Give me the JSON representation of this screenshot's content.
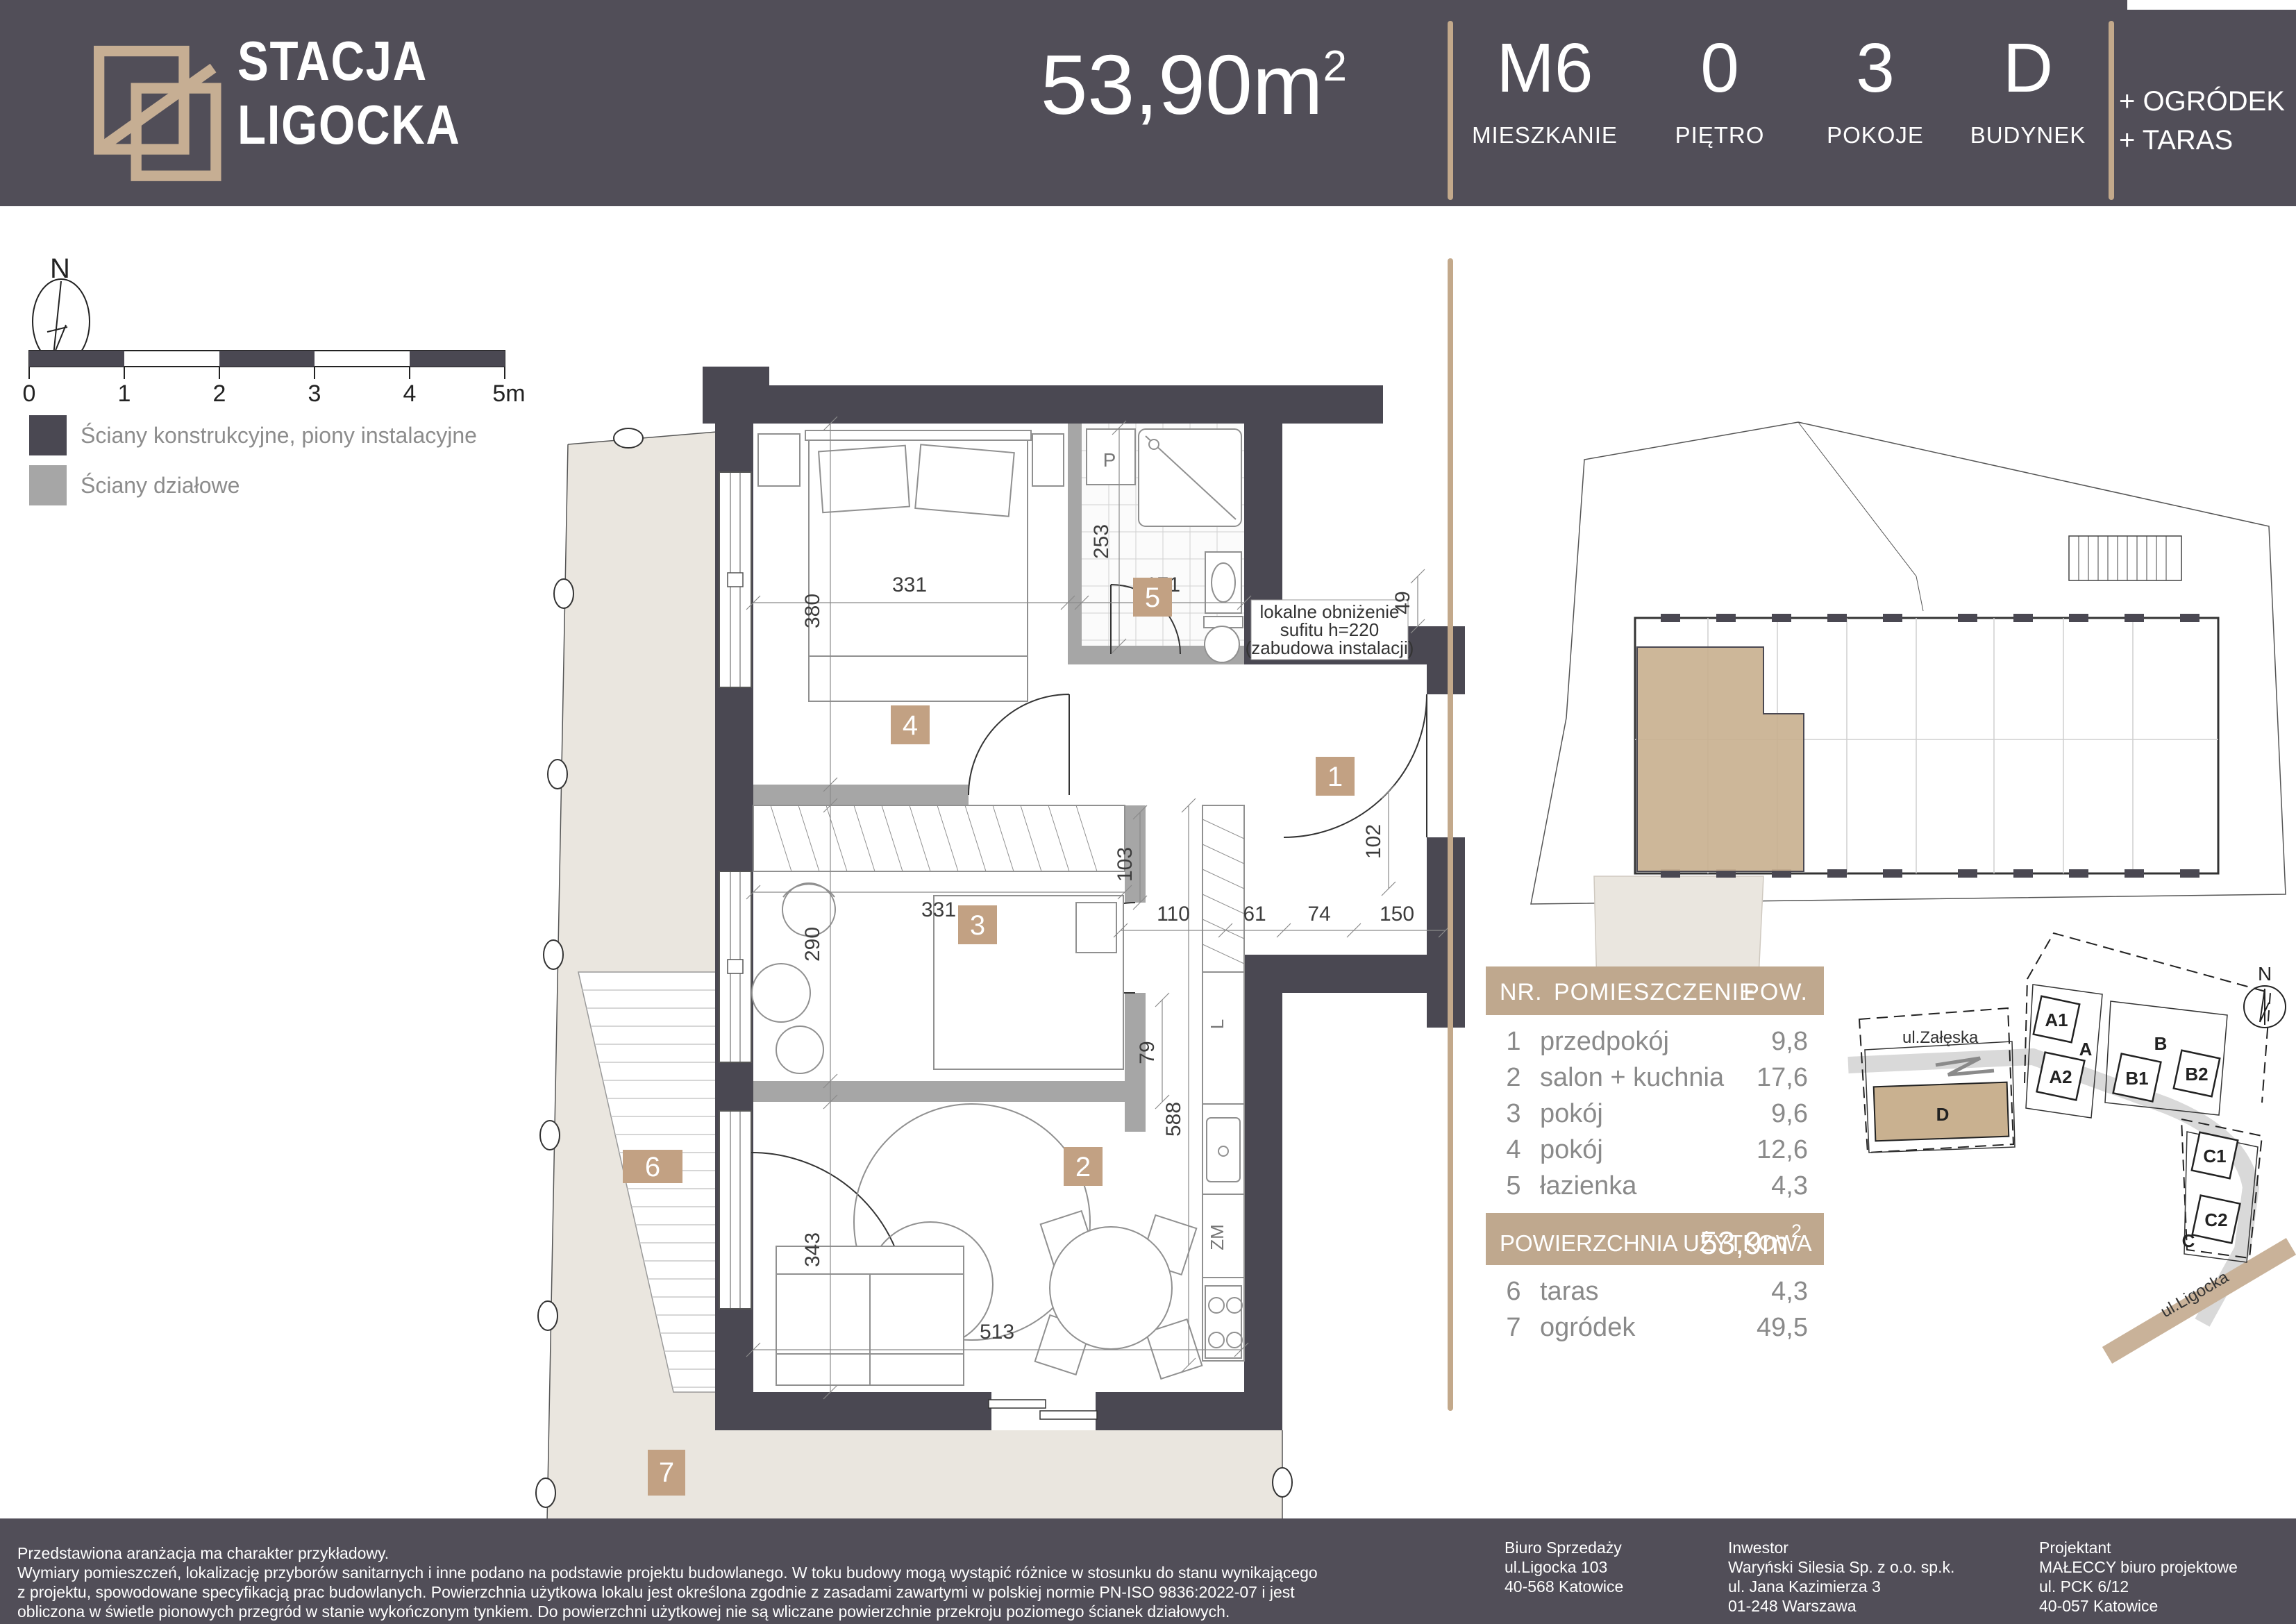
{
  "header": {
    "brand_line1": "STACJA",
    "brand_line2": "LIGOCKA",
    "area_value": "53,90m",
    "area_sup": "2",
    "units": [
      {
        "value": "M6",
        "label": "MIESZKANIE"
      },
      {
        "value": "0",
        "label": "PIĘTRO"
      },
      {
        "value": "3",
        "label": "POKOJE"
      },
      {
        "value": "D",
        "label": "BUDYNEK"
      }
    ],
    "extras_line1": "+ OGRÓDEK",
    "extras_line2": "+ TARAS"
  },
  "legend": {
    "north": "N",
    "scale_ticks": [
      "0",
      "1",
      "2",
      "3",
      "4",
      "5m"
    ],
    "items": [
      {
        "label": "Ściany konstrukcyjne, piony instalacyjne",
        "color": "#4A4852"
      },
      {
        "label": "Ściany działowe",
        "color": "#A6A6A6"
      }
    ]
  },
  "plan": {
    "badges": [
      "1",
      "2",
      "3",
      "4",
      "5",
      "6",
      "7"
    ],
    "dims": {
      "room4_w": "331",
      "room4_h": "380",
      "bath_w": "171",
      "bath_h": "253",
      "hall_a": "110",
      "hall_b": "61",
      "hall_c": "74",
      "door": "150",
      "hall_h": "103",
      "entry_h": "102",
      "shaft": "49",
      "corridor": "79",
      "wardrobe": "331",
      "room3_h": "290",
      "salon_h": "343",
      "kitchen_h": "588",
      "salon_w": "513"
    },
    "ceiling_note_1": "lokalne obniżenie",
    "ceiling_note_2": "sufitu h=220",
    "ceiling_note_3": "(zabudowa instalacji)",
    "labels": {
      "washer": "P",
      "fridge": "L",
      "dishwasher": "ZM"
    }
  },
  "table": {
    "col_nr": "NR.",
    "col_room": "POMIESZCZENIE",
    "col_pow": "POW.",
    "rows": [
      {
        "no": "1",
        "name": "przedpokój",
        "area": "9,8"
      },
      {
        "no": "2",
        "name": "salon + kuchnia",
        "area": "17,6"
      },
      {
        "no": "3",
        "name": "pokój",
        "area": "9,6"
      },
      {
        "no": "4",
        "name": "pokój",
        "area": "12,6"
      },
      {
        "no": "5",
        "name": "łazienka",
        "area": "4,3"
      }
    ],
    "total_label": "POWIERZCHNIA UŻYTKOWA",
    "total_value": "53,9m",
    "total_sup": "2",
    "outdoor_rows": [
      {
        "no": "6",
        "name": "taras",
        "area": "4,3"
      },
      {
        "no": "7",
        "name": "ogródek",
        "area": "49,5"
      }
    ]
  },
  "site": {
    "north": "N",
    "street_top": "ul.Załęska",
    "street_bottom": "ul.Ligocka",
    "buildings": {
      "a1": "A1",
      "a": "A",
      "a2": "A2",
      "b1": "B1",
      "b": "B",
      "b2": "B2",
      "c1": "C1",
      "c2": "C2",
      "c": "C",
      "d": "D"
    }
  },
  "footer": {
    "disclaimer": [
      "Przedstawiona aranżacja ma charakter przykładowy.",
      "Wymiary pomieszczeń, lokalizację przyborów sanitarnych i inne podano na podstawie projektu budowlanego. W toku budowy mogą wystąpić różnice w stosunku do stanu wynikającego",
      "z projektu, spowodowane specyfikacją prac budowlanych. Powierzchnia użytkowa lokalu jest określona zgodnie z zasadami zawartymi w polskiej normie PN-ISO 9836:2022-07 i jest",
      "obliczona w świetle pionowych przegród w stanie wykończonym tynkiem. Do powierzchni użytkowej nie są wliczane powierzchnie przekroju poziomego ścianek działowych."
    ],
    "columns": [
      {
        "title": "Biuro Sprzedaży",
        "l1": "ul.Ligocka 103",
        "l2": "40-568 Katowice",
        "l3": ""
      },
      {
        "title": "Inwestor",
        "l1": "Waryński Silesia Sp. z o.o. sp.k.",
        "l2": "ul. Jana Kazimierza 3",
        "l3": "01-248 Warszawa"
      },
      {
        "title": "Projektant",
        "l1": "MAŁECCY biuro projektowe",
        "l2": "ul. PCK 6/12",
        "l3": "40-057 Katowice"
      }
    ]
  }
}
